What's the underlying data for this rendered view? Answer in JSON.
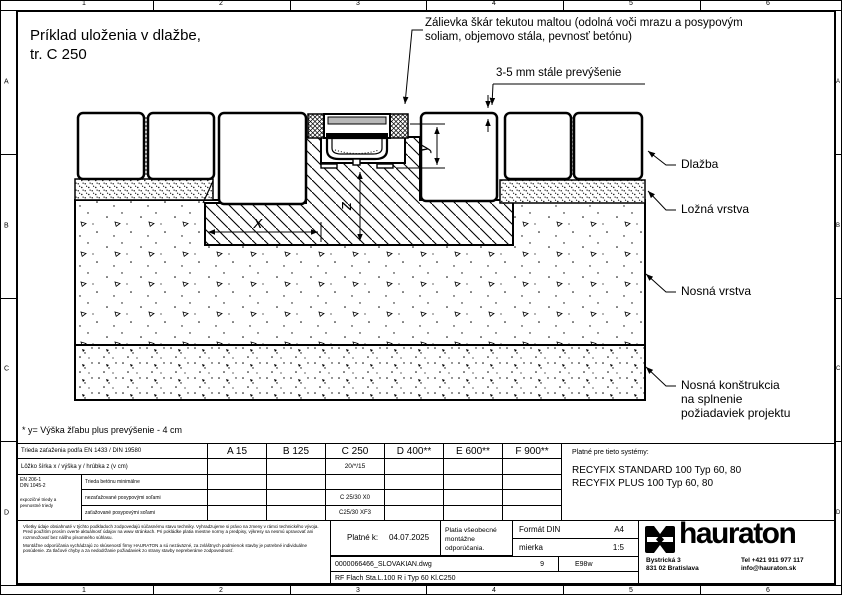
{
  "frame": {
    "columns": [
      "1",
      "2",
      "3",
      "4",
      "5",
      "6"
    ],
    "rows": [
      "A",
      "B",
      "C",
      "D"
    ]
  },
  "drawing": {
    "title_line1": "Príklad uloženia v dlažbe,",
    "title_line2": "tr. C 250",
    "grout_note_line1": "Zálievka škár tekutou maltou (odolná voči mrazu a posypovým",
    "grout_note_line2": "soliam, objemovo stála, pevnosť betónu)",
    "overhang_note": "3-5 mm stále prevýšenie",
    "label_paving": "Dlažba",
    "label_bedding": "Ložná vrstva",
    "label_base": "Nosná vrstva",
    "label_subbase_line1": "Nosná konštrukcia",
    "label_subbase_line2": "na splnenie",
    "label_subbase_line3": "požiadaviek projektu",
    "dim_x": "x",
    "dim_y": "y",
    "dim_z": "z",
    "footnote": "* y= Výška žľabu plus prevýšenie - 4 cm"
  },
  "load_table": {
    "row1_label": "Trieda zaťaženia podľa EN 1433 / DIN 19580",
    "classes": [
      "A 15",
      "B 125",
      "C 250",
      "D 400**",
      "E 600**",
      "F 900**"
    ],
    "row2_label": "Lôžko šírka x / výška y / hrúbka z (v cm)",
    "row2_c250": "20/*/15",
    "norm_line1": "EN 206-1",
    "norm_line2": "DIN 1045-2",
    "norm_note_line1": "expozičné triedy a",
    "norm_note_line2": "pevnostné triedy",
    "row3_label": "Trieda betónu minimálne",
    "row4_label": "nezaťažované posypovými soľami",
    "row4_c250": "C 25/30 X0",
    "row5_label": "zaťažované posypovými soľami",
    "row5_c250": "C25/30 XF3",
    "systems_title": "Platné pre tieto systémy:",
    "system_1": "RECYFIX STANDARD 100 Typ 60, 80",
    "system_2": "RECYFIX PLUS 100 Typ 60, 80"
  },
  "footer": {
    "disclaimer_p1": "Všetky údaje obsiahnuté v týchto podkladoch zodpovedajú súčasnému stavu techniky. Vyhradzujeme si právo na zmeny v rámci technického vývoja. Pred použitím prosím overte aktuálnosť údajov na www stránkach. Pri pokládke platia miestne normy a predpisy, výkresy sa nesmú upravovať ani rozmnožovať bez nášho písomného súhlasu.",
    "disclaimer_p2": "Montážne odporúčania vychádzajú zo skúseností firmy HAURATON a sú nezáväzné, za zvláštnych podmienok stavby je potrebné individuálne posúdenie. Za tlačové chyby a za nedodržanie požiadaviek zo strany stavby nepreberáme zodpovednosť.",
    "valid_label": "Platné k:",
    "valid_date": "04.07.2025",
    "note_line1": "Platia všeobecné",
    "note_line2": "montážne odporúčania.",
    "format_label": "Formát DIN",
    "format_value": "A4",
    "scale_label": "mierka",
    "scale_value": "1:5",
    "file_name": "0000066466_SLOVAKIAN.dwg",
    "revision": "9",
    "code": "E98w",
    "drawing_name": "RF Flach Sta.L.100 R i Typ 60 Kl.C250"
  },
  "brand": {
    "wordmark": "hauraton",
    "address_line1": "Bystrická 3",
    "address_line2": "831 02 Bratislava",
    "tel": "Tel +421 911 977 117",
    "email": "info@hauraton.sk"
  }
}
